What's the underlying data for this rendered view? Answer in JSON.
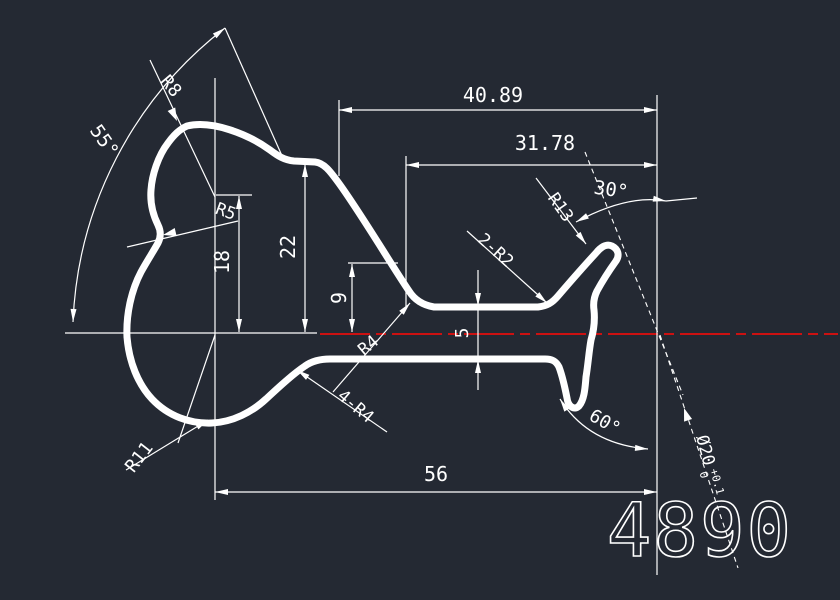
{
  "drawing": {
    "colors": {
      "background": "#242933",
      "line": "#ffffff",
      "centerline": "#cc1111"
    },
    "part_number": "4890",
    "labels": {
      "dim_40_89": "40.89",
      "dim_31_78": "31.78",
      "dim_56": "56",
      "dim_22": "22",
      "dim_18": "18",
      "dim_9": "9",
      "dim_5": "5",
      "angle_55": "55°",
      "angle_30": "30°",
      "angle_60": "60°",
      "radius_r8": "R8",
      "radius_r5": "R5",
      "radius_r11": "R11",
      "radius_r13": "R13",
      "radius_r4": "R4",
      "fillets_4_r4": "4-R4",
      "fillets_2_r2": "2-R2",
      "diameter": "Ø20",
      "diameter_tol_upper": "+0.1",
      "diameter_tol_lower": "0"
    }
  }
}
